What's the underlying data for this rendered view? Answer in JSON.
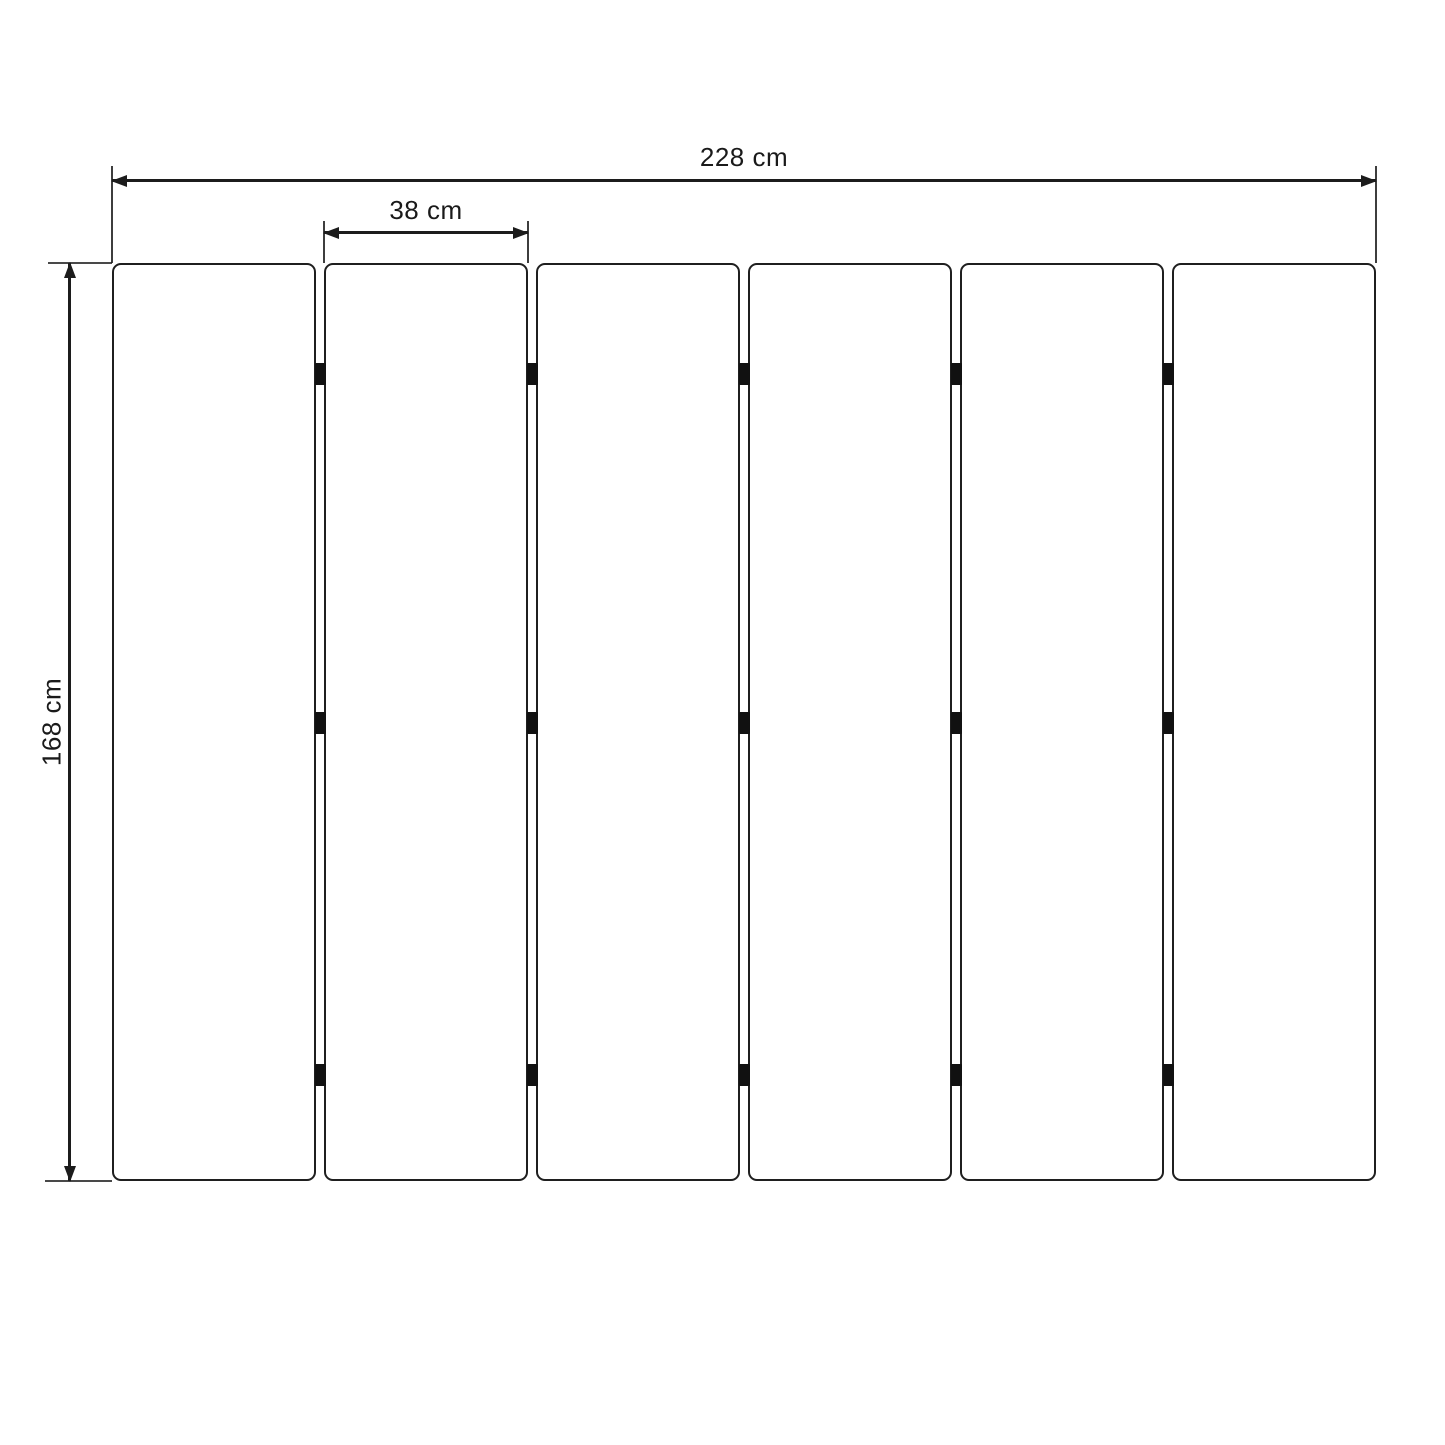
{
  "diagram": {
    "type": "dimension-diagram",
    "subject": "slatted-panel-top-view",
    "unit": "cm",
    "dimensions": {
      "total_width": {
        "label": "228 cm",
        "value": 228
      },
      "panel_width": {
        "label": "38 cm",
        "value": 38
      },
      "height": {
        "label": "168 cm",
        "value": 168
      }
    },
    "panels": {
      "count": 6,
      "gap_count": 5,
      "connectors_per_gap": 3,
      "connector_row_fractions": [
        0.121,
        0.501,
        0.885
      ]
    },
    "colors": {
      "line": "#1c1c1c",
      "panel_border": "#1f1f1f",
      "connector": "#111111",
      "background": "#ffffff",
      "text": "#1a1a1a"
    }
  }
}
